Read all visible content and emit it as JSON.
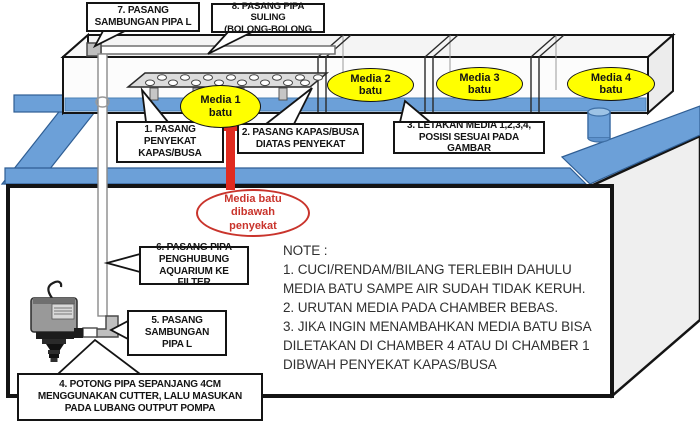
{
  "callouts": {
    "c1": {
      "text": "1. PASANG\nPENYEKAT\nKAPAS/BUSA"
    },
    "c2": {
      "text": "2. PASANG KAPAS/BUSA\nDIATAS PENYEKAT"
    },
    "c3": {
      "text": "3. LETAKAN MEDIA 1,2,3,4,\nPOSISI SESUAI PADA GAMBAR"
    },
    "c4": {
      "text": "4. POTONG PIPA SEPANJANG 4CM\nMENGGUNAKAN CUTTER, LALU MASUKAN\nPADA LUBANG OUTPUT POMPA"
    },
    "c5": {
      "text": "5. PASANG\nSAMBUNGAN\nPIPA L"
    },
    "c6": {
      "text": "6. PASANG PIPA\nPENGHUBUNG\nAQUARIUM KE FILTER"
    },
    "c7": {
      "text": "7. PASANG\nSAMBUNGAN PIPA L"
    },
    "c8": {
      "text": "8. PASANG PIPA SULING\n(BOLONG-BOLONG"
    }
  },
  "media_labels": {
    "m1": "Media 1\nbatu",
    "m2": "Media 2\nbatu",
    "m3": "Media 3\nbatu",
    "m4": "Media 4\nbatu"
  },
  "highlight": {
    "text": "Media batu\ndibawah\npenyekat"
  },
  "note": {
    "title": "NOTE :",
    "lines": [
      "1. CUCI/RENDAM/BILANG TERLEBIH DAHULU",
      "MEDIA BATU SAMPE AIR SUDAH TIDAK KERUH.",
      "2. URUTAN MEDIA PADA CHAMBER BEBAS.",
      "3. JIKA INGIN MENAMBAHKAN MEDIA BATU BISA",
      "DILETAKAN DI CHAMBER 4 ATAU DI CHAMBER 1",
      "DIBWAH PENYEKAT KAPAS/BUSA"
    ]
  },
  "colors": {
    "water_blue": "#6CA0D8",
    "media_yellow": "#FFFF00",
    "highlight_red": "#C9342C",
    "arrow_red": "#E02B20",
    "outline_black": "#141414"
  }
}
